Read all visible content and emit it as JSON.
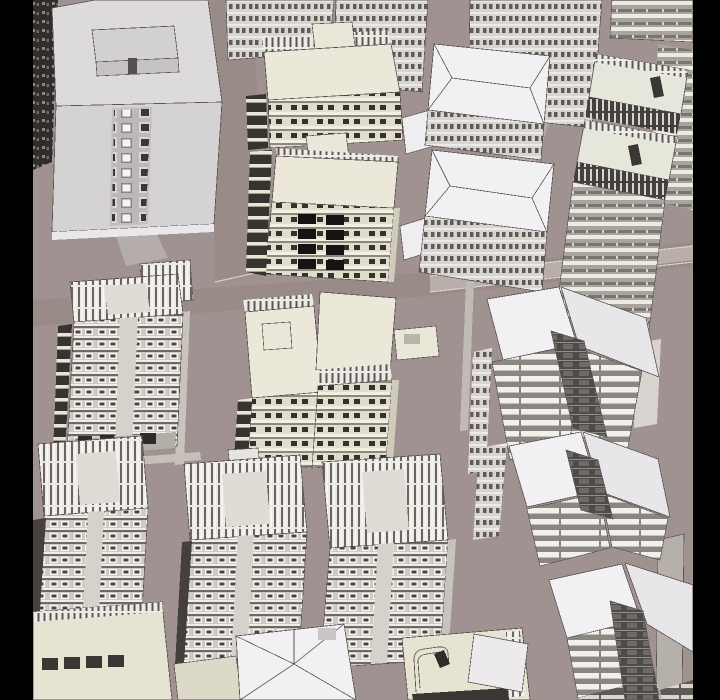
{
  "scene": {
    "kind": "aerial-3d-city-model-render",
    "letterbox": {
      "left_width": 33,
      "right_width": 27
    }
  },
  "colors": {
    "letterbox": "#000000",
    "ground": "#a09290",
    "street_shade": "#998b87",
    "street_light": "#b8afaa",
    "sidewalk": "#c9c3bd",
    "roof_gray": "#dcdadb",
    "facade_gray": "#d5d2d4",
    "skirt": "#e8e7e9",
    "roof_white": "#f1f0f2",
    "roof_white_shaded": "#e7e6e9",
    "cream": "#e6e3d2",
    "cream_roof": "#ebe8da",
    "cream_panel": "#e9e7d8",
    "deck_green": "#e5e7db",
    "slats_panel": "#dfdcd6",
    "channel_dark": "#4e4a47",
    "dark_side": "#37332f",
    "window_black": "#161412",
    "edge_dark": "#45403d",
    "ground_floor": "#b3aea7",
    "chimney": "#b6b0aa",
    "low_cream": "#ddd9c8"
  },
  "buildings": [
    {
      "id": "tower-top-left",
      "style": "plain gray slab, roof penthouse, central window strip"
    },
    {
      "id": "dark-shadow-facade",
      "style": "shadowed window texture at left edge"
    },
    {
      "id": "background-towers",
      "style": "dense window grids receding at top"
    },
    {
      "id": "cream-tower-upper",
      "style": "cream roof, balcony stack"
    },
    {
      "id": "cream-tower-lower",
      "style": "cream roof, black window pairs"
    },
    {
      "id": "hip-roof-block-1",
      "style": "white cross hip roof over window band"
    },
    {
      "id": "hip-roof-block-2",
      "style": "white cross hip roof over window band"
    },
    {
      "id": "balcony-slab-tower",
      "style": "roof decks, railing bands, horizontal stripes"
    },
    {
      "id": "slat-roof-tower-mid-left",
      "style": "vertical slat roof, 12 window floors"
    },
    {
      "id": "cream-pair-left",
      "style": "cream roof with rooftop box"
    },
    {
      "id": "cream-pair-right",
      "style": "cream roof with side annex"
    },
    {
      "id": "butterfly-wing-1",
      "style": "white roof panels, dark stair channel, louver facade"
    },
    {
      "id": "butterfly-wing-2",
      "style": "white roof panels, dark stair channel, louver facade"
    },
    {
      "id": "butterfly-wing-3",
      "style": "white roof panels, glazed channel to street"
    },
    {
      "id": "slat-roof-tower-bottom-1",
      "style": "vertical slat roof tower"
    },
    {
      "id": "slat-roof-tower-bottom-2",
      "style": "vertical slat roof tower"
    },
    {
      "id": "slat-roof-tower-bottom-3",
      "style": "vertical slat roof tower"
    },
    {
      "id": "cream-podium",
      "style": "low cream block, dark window row"
    },
    {
      "id": "white-hip-podium",
      "style": "large white cross hip roof"
    },
    {
      "id": "ornate-roof-podium",
      "style": "cream roof, curved parapet, roof object"
    }
  ]
}
